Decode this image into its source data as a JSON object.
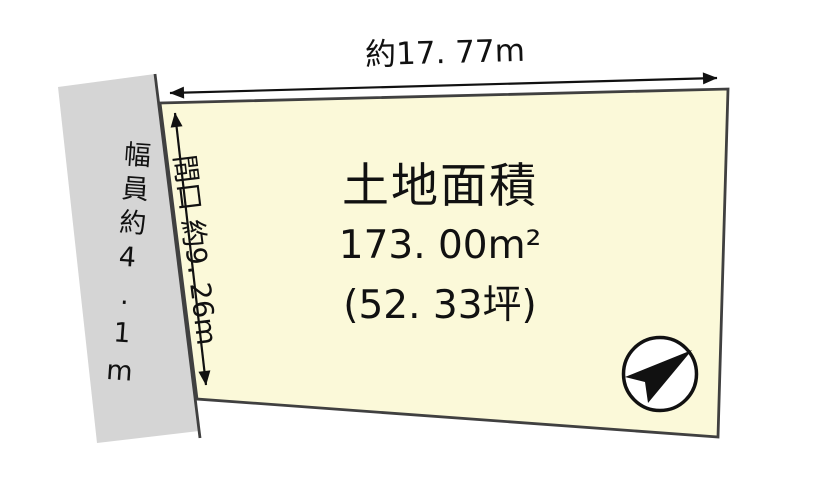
{
  "diagram": {
    "top_dimension_label": "約17. 77m",
    "frontage_label": "間口 約9. 26m",
    "road_width_label": "幅員約4.1m",
    "area_title": "土地面積",
    "area_m2": "173. 00m²",
    "area_tsubo": "(52. 33坪)",
    "north_arrow_icon": "north-arrow-icon"
  },
  "colors": {
    "parcel_fill": "#FBF9D9",
    "parcel_stroke": "#404040",
    "road_fill": "#D5D5D5",
    "ink": "#111111",
    "compass_fill": "#FFFFFF"
  }
}
